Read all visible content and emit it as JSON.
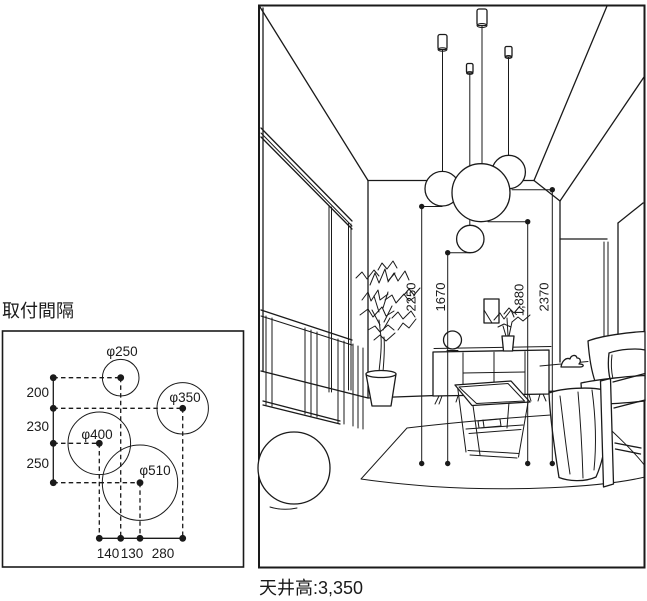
{
  "spacing": {
    "title": "取付間隔",
    "circles": [
      {
        "label": "φ250"
      },
      {
        "label": "φ350"
      },
      {
        "label": "φ400"
      },
      {
        "label": "φ510"
      }
    ],
    "row_spacings": [
      {
        "label": "200"
      },
      {
        "label": "230"
      },
      {
        "label": "250"
      }
    ],
    "col_spacings": [
      {
        "label": "140"
      },
      {
        "label": "130"
      },
      {
        "label": "280"
      }
    ]
  },
  "room": {
    "drop_heights": [
      {
        "label": "2250"
      },
      {
        "label": "1670"
      },
      {
        "label": "1,880"
      },
      {
        "label": "2370"
      }
    ],
    "caption": "天井高:3,350"
  },
  "colors": {
    "line": "#1a1a1a",
    "background": "#ffffff"
  }
}
